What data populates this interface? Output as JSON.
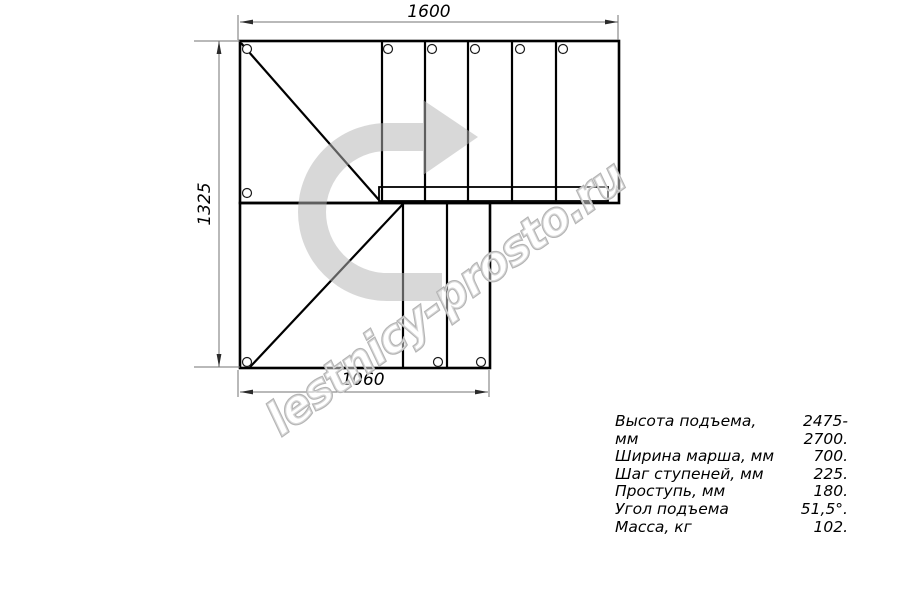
{
  "drawing": {
    "dimension_top": "1600",
    "dimension_left": "1325",
    "dimension_bottom": "1060",
    "watermark": "lestnicy-prosto.ru"
  },
  "specs": {
    "rows": [
      {
        "label": "Высота подъема, мм",
        "value": "2475-2700."
      },
      {
        "label": "Ширина марша, мм",
        "value": "700."
      },
      {
        "label": "Шаг ступеней, мм",
        "value": "225."
      },
      {
        "label": "Проступь, мм",
        "value": "180."
      },
      {
        "label": "Угол подъема",
        "value": "51,5°."
      },
      {
        "label": "Масса, кг",
        "value": "102."
      }
    ]
  },
  "colors": {
    "outline": "#000000",
    "dimension_line": "#737373",
    "direction_arrow": "#d8d8d8",
    "watermark_outline": "#b4b4b4"
  }
}
